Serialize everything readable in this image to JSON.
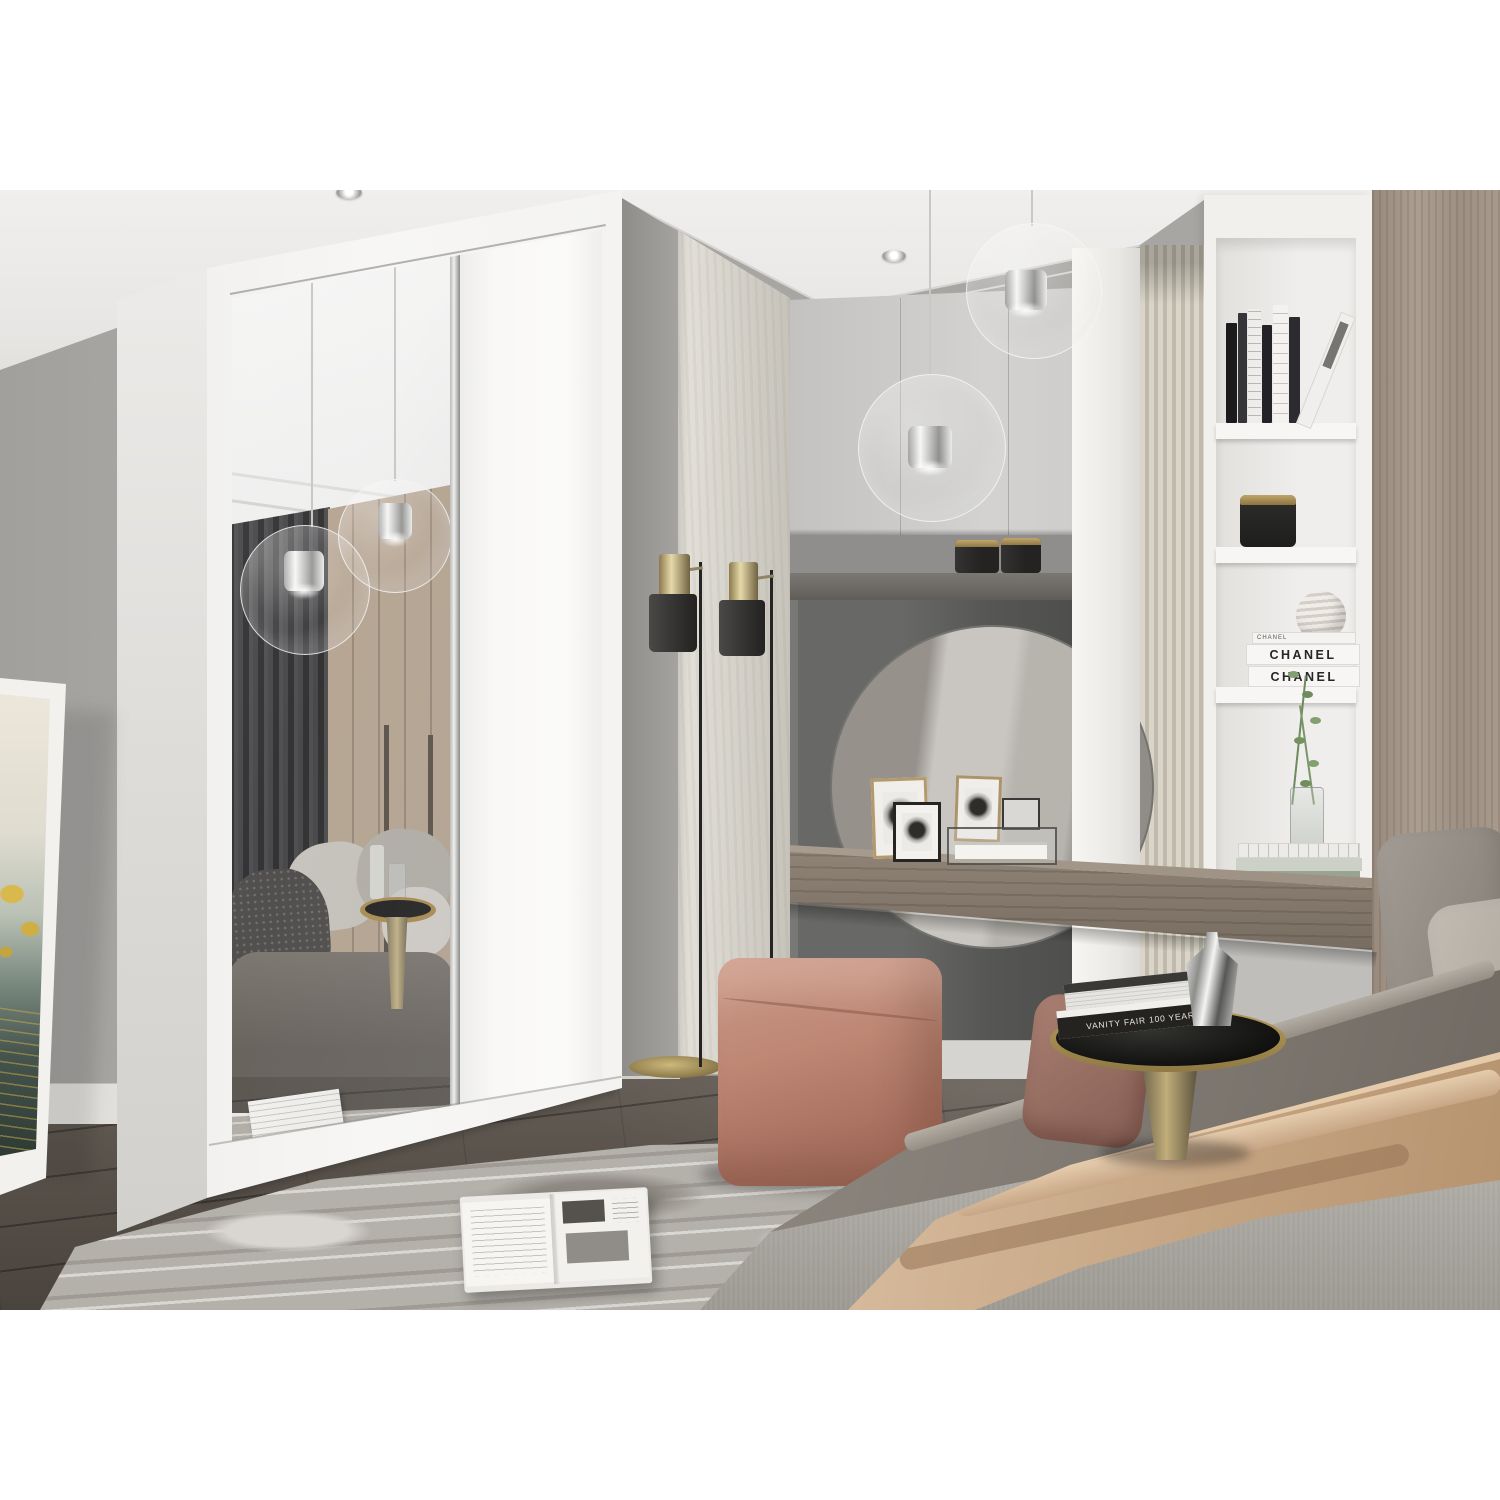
{
  "meta": {
    "type": "interior-photograph",
    "subject": "Modern bedroom render with a white two-door sliding wardrobe (one mirrored door, one plain white door), a vanity nook with round mirror, a white shelving column with decor, glass globe pendant lights, black floor lamps, a pink cube pouf, a marbled rug, an open magazine and a bed with a beige throw",
    "framing": "photograph letterboxed with white bars at top and bottom"
  },
  "palette": {
    "letterbox": "#ffffff",
    "wall": "#b0aeab",
    "ceiling": "#edecea",
    "floor_wood": "#554e47",
    "wardrobe_white": "#f5f4f2",
    "mirror_wood_reflection": "#b5a390",
    "curtain_reflection": "#424244",
    "vanity_niche": "#565655",
    "cabinet_gray": "#cbcac8",
    "reeded_panel": "#d2cdbf",
    "shelf_white": "#f1f0ed",
    "headboard_wood": "#a5988b",
    "desk_wood": "#8b7f72",
    "pouf_pink": "#bb8672",
    "rug_marble": "#b4b0aa",
    "bed_gray": "#847e77",
    "throw_beige": "#cdae8e",
    "brass": "#ac9159",
    "lamp_black": "#343331"
  },
  "texts": {
    "chanel_spine_thin": "CHANEL",
    "chanel_spine_1": "CHANEL",
    "chanel_spine_2": "CHANEL",
    "vanity_fair_spine": "VANITY FAIR 100 YEARS"
  },
  "objects": [
    "sliding-door wardrobe with mirror door",
    "leaning framed botanical artwork",
    "two black-and-brass floor lamps",
    "two clear glass globe pendant lights",
    "recessed ceiling spotlights",
    "gray upper cabinets",
    "two black canisters with brass lids",
    "round vanity mirror",
    "picture frames and glass display box on floating desk",
    "white shelving column with books, candle jar, striped sphere, CHANEL books and eucalyptus vase",
    "reeded cream wall panel",
    "wood headboard panel",
    "bed with gray pillows, gray duvet and beige throw",
    "round side table with VANITY FAIR books and chrome vase",
    "mauve floor cushion",
    "pink cube pouf",
    "marbled area rug with open magazine",
    "dark wood plank floor"
  ]
}
